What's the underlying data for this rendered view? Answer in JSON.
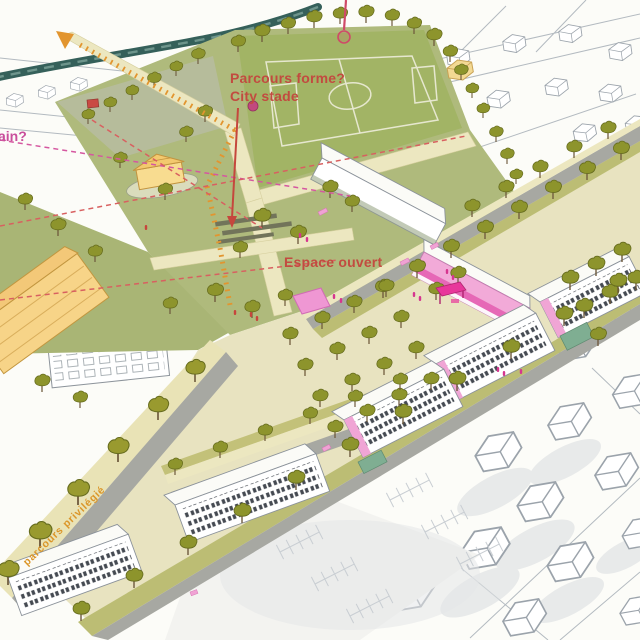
{
  "annotations": {
    "parcours_forme": {
      "line1": "Parcours forme?",
      "line2": "City stade",
      "color": "#c24b40"
    },
    "espace_ouvert": {
      "text": "Espace ouvert",
      "color": "#c24b40"
    },
    "edge_partial": {
      "text": "ain?",
      "color": "#c94f9c"
    },
    "street_label": {
      "text": "parcours privilégié",
      "color": "#db9629"
    }
  },
  "palette": {
    "paper": "#fcfcf8",
    "park_green": "#afba7c",
    "field_green": "#a2b465",
    "nw_triangle_green": "#b6bc9b",
    "esplanade_beige": "#e8e3c0",
    "path_cream": "#ece7c0",
    "road_gray": "#a7a8a2",
    "verge_olive": "#bcbd74",
    "tree_olive": "#8d942c",
    "teal_hedge": "#35605a",
    "building_yellow": "#f7d488",
    "accent_pink": "#f0a5d5",
    "strong_pink": "#e8379b",
    "annotation_red": "#c24b40",
    "route_orange": "#e2952f",
    "sketch_gray": "#9ba3ab",
    "window_dark": "#454a52"
  }
}
